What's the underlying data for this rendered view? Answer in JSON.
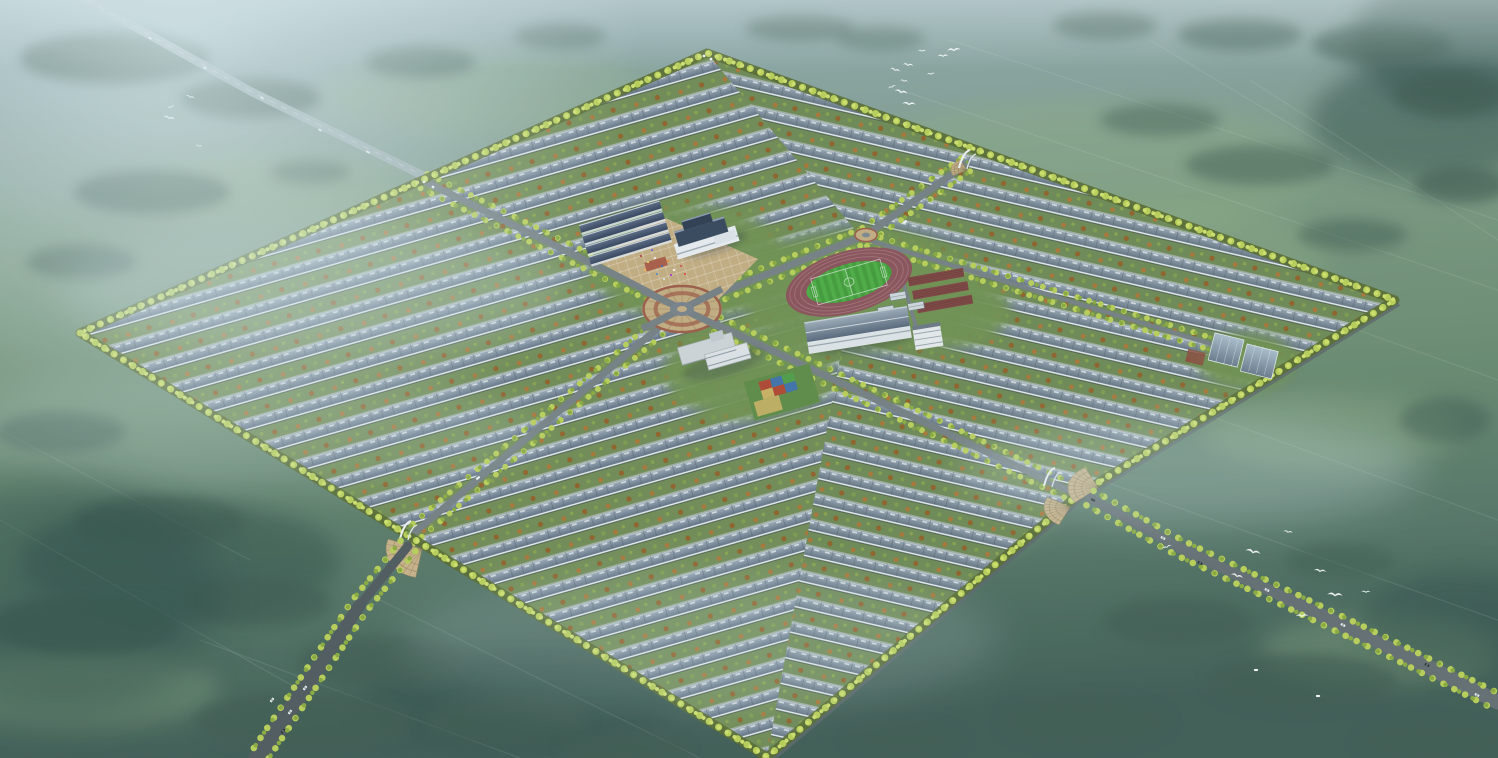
{
  "meta": {
    "scene_type": "aerial-architectural-rendering",
    "subject": "planned rural residential community master plan, bird's-eye view, misty farmland"
  },
  "palette": {
    "bgStops": [
      [
        0,
        "#93adb4"
      ],
      [
        0.18,
        "#86a09b"
      ],
      [
        0.35,
        "#78967f"
      ],
      [
        0.55,
        "#6b8b70"
      ],
      [
        0.78,
        "#547465"
      ],
      [
        1,
        "#3d5a52"
      ]
    ],
    "treeCluster": "#3e5a50",
    "lightField": "#8fae84",
    "darkField": "#2f4d47",
    "siteBase": "#7b8a7a",
    "roofDark": "#56667a",
    "roofLight": "#9fadb9",
    "roofDarkR": "#5a6a79",
    "roofLightR": "#9aa8b4",
    "courtyard": "#6f8a53",
    "courtyardR": "#6c8752",
    "eaveWhite": "#eaeff2",
    "treeYellow": "#b9cf55",
    "treeYellowLight": "#cfe06a",
    "treeOlive": "#88a83c",
    "treeBorderDark": "#55682e",
    "roadGray": "#747e82",
    "roadDark": "#4e585c",
    "roadMid": "#626c70",
    "highway": "#a3b2b7",
    "plazaTan": "#c3ac80",
    "ringBrown": "#9c5a45",
    "trackRed": "#8a5058",
    "pitchGreen": "#3f9b37",
    "pitchStripe": "#4bac41",
    "plotRed": "#7e4340",
    "glassTop": "#a9bcca",
    "glassBottom": "#68798a",
    "wallWhite": "#e7ebee",
    "navyRoof": "#33405c",
    "fogWhite": "#dfeef2",
    "birdWhite": "#f5f9f9",
    "carWhite": "#eef2f4",
    "carDark": "#23282c"
  },
  "background": {
    "lightPatches": [
      [
        500,
        95,
        180,
        40
      ],
      [
        1160,
        250,
        170,
        45
      ],
      [
        1080,
        170,
        240,
        70
      ],
      [
        1330,
        430,
        130,
        40
      ],
      [
        260,
        190,
        140,
        35
      ],
      [
        890,
        520,
        160,
        40
      ],
      [
        1380,
        650,
        120,
        35
      ],
      [
        80,
        690,
        140,
        40
      ]
    ],
    "darkPatches": [
      [
        1430,
        120,
        120,
        60
      ],
      [
        1470,
        40,
        120,
        70
      ],
      [
        1460,
        620,
        100,
        50
      ],
      [
        180,
        560,
        160,
        60
      ],
      [
        520,
        700,
        160,
        50
      ]
    ],
    "fieldLines": [
      [
        950,
        40,
        1498,
        220
      ],
      [
        900,
        90,
        1498,
        290
      ],
      [
        880,
        160,
        1498,
        380
      ],
      [
        1000,
        340,
        1498,
        520
      ],
      [
        1100,
        480,
        1498,
        620
      ],
      [
        150,
        380,
        680,
        650
      ],
      [
        0,
        430,
        250,
        560
      ],
      [
        0,
        520,
        300,
        690
      ],
      [
        1150,
        40,
        1350,
        160
      ],
      [
        1250,
        80,
        1498,
        240
      ],
      [
        380,
        600,
        700,
        758
      ],
      [
        200,
        640,
        520,
        758
      ]
    ],
    "treeClusters": [
      [
        115,
        58,
        95,
        26,
        0.75
      ],
      [
        250,
        98,
        70,
        20,
        0.7
      ],
      [
        420,
        62,
        55,
        16,
        0.5
      ],
      [
        560,
        36,
        46,
        13,
        0.45
      ],
      [
        152,
        192,
        78,
        22,
        0.65
      ],
      [
        82,
        262,
        55,
        17,
        0.6
      ],
      [
        310,
        172,
        40,
        12,
        0.5
      ],
      [
        800,
        28,
        55,
        13,
        0.5
      ],
      [
        880,
        38,
        45,
        12,
        0.45
      ],
      [
        1105,
        25,
        52,
        14,
        0.55
      ],
      [
        1240,
        34,
        62,
        16,
        0.6
      ],
      [
        1382,
        44,
        70,
        20,
        0.65
      ],
      [
        1448,
        95,
        55,
        22,
        0.7
      ],
      [
        1462,
        185,
        48,
        18,
        0.65
      ],
      [
        1260,
        165,
        75,
        20,
        0.5
      ],
      [
        1160,
        120,
        60,
        16,
        0.45
      ],
      [
        1352,
        235,
        55,
        16,
        0.5
      ],
      [
        1445,
        420,
        45,
        22,
        0.5
      ],
      [
        60,
        432,
        65,
        20,
        0.6
      ],
      [
        160,
        522,
        85,
        26,
        0.7
      ],
      [
        85,
        625,
        95,
        30,
        0.75
      ],
      [
        255,
        602,
        75,
        24,
        0.7
      ],
      [
        382,
        662,
        85,
        26,
        0.7
      ],
      [
        305,
        722,
        110,
        30,
        0.75
      ],
      [
        505,
        722,
        85,
        24,
        0.7
      ],
      [
        625,
        748,
        65,
        18,
        0.65
      ],
      [
        1178,
        622,
        75,
        24,
        0.65
      ],
      [
        1302,
        682,
        95,
        28,
        0.7
      ],
      [
        1432,
        742,
        75,
        22,
        0.7
      ],
      [
        1085,
        722,
        85,
        26,
        0.65
      ],
      [
        1340,
        562,
        55,
        18,
        0.5
      ],
      [
        905,
        740,
        60,
        16,
        0.6
      ]
    ]
  },
  "highway": {
    "pts": [
      [
        76,
        -6
      ],
      [
        252,
        92
      ],
      [
        432,
        180
      ]
    ],
    "width": 8.5,
    "cars": [
      [
        150,
        38
      ],
      [
        205,
        68
      ],
      [
        262,
        98
      ],
      [
        320,
        130
      ],
      [
        368,
        152
      ]
    ]
  },
  "site": {
    "polygon": [
      [
        80,
        333
      ],
      [
        707,
        53
      ],
      [
        1395,
        300
      ],
      [
        1078,
        495
      ],
      [
        767,
        757
      ]
    ],
    "leftZone": [
      [
        80,
        333
      ],
      [
        707,
        53
      ],
      [
        862,
        238
      ],
      [
        767,
        757
      ]
    ],
    "rightZone": [
      [
        707,
        53
      ],
      [
        1395,
        300
      ],
      [
        1078,
        495
      ],
      [
        767,
        757
      ],
      [
        862,
        238
      ]
    ],
    "wallEdge": [
      [
        1395,
        300
      ],
      [
        1078,
        495
      ],
      [
        767,
        757
      ]
    ],
    "rowAngleLeft": -16,
    "rowAngleRight": 13
  },
  "lawns": [
    [
      688,
      262,
      100,
      58
    ],
    [
      858,
      290,
      120,
      62
    ],
    [
      748,
      372,
      85,
      48
    ],
    [
      940,
      310,
      70,
      40
    ],
    [
      1246,
      362,
      48,
      30
    ]
  ],
  "internalRoads": [
    {
      "pts": [
        [
          424,
          181
        ],
        [
          682,
          308
        ],
        [
          1078,
          495
        ]
      ],
      "w": 7,
      "perp": [
        3.5,
        -7.2
      ],
      "trees": true
    },
    {
      "pts": [
        [
          408,
          538
        ],
        [
          682,
          308
        ],
        [
          866,
          235
        ],
        [
          968,
          163
        ]
      ],
      "w": 7,
      "perp": [
        4.5,
        6.6
      ],
      "trees": true
    },
    {
      "pts": [
        [
          868,
          240
        ],
        [
          1238,
          352
        ]
      ],
      "w": 4.5,
      "perp": [
        -1,
        6
      ],
      "trees": true
    },
    {
      "pts": [
        [
          893,
          247
        ],
        [
          917,
          330
        ]
      ],
      "w": 4,
      "perp": [
        0,
        0
      ],
      "trees": false
    }
  ],
  "features": {
    "plaza": {
      "polygon": [
        [
          598,
          262
        ],
        [
          654,
          213
        ],
        [
          758,
          259
        ],
        [
          702,
          316
        ]
      ],
      "carpet": {
        "x": 656,
        "y": 264,
        "w": 22,
        "h": 9,
        "rot": -17
      },
      "people": [
        [
          641,
          256
        ],
        [
          648,
          262
        ],
        [
          655,
          258
        ],
        [
          662,
          266
        ],
        [
          668,
          261
        ],
        [
          674,
          270
        ],
        [
          681,
          266
        ],
        [
          657,
          274
        ],
        [
          664,
          279
        ],
        [
          671,
          275
        ],
        [
          645,
          270
        ],
        [
          678,
          258
        ],
        [
          685,
          274
        ],
        [
          652,
          250
        ]
      ],
      "peopleColors": [
        "#b44444",
        "#ddd666",
        "#eeeeee",
        "#4466aa",
        "#ee8833",
        "#ffffff",
        "#cc5555",
        "#5588bb",
        "#dddddd",
        "#aa33cc",
        "#ffaa55",
        "#eeeeee",
        "#dd4444",
        "#6666cc"
      ]
    },
    "schoolRows": {
      "cx": 625,
      "cy": 232,
      "rot": -17,
      "count": 4,
      "len": 84
    },
    "townHall": {
      "cx": 708,
      "cy": 240,
      "rot": -17
    },
    "circlePlaza": {
      "cx": 682,
      "cy": 309,
      "rx": 40,
      "ry": 24,
      "spokes": 16
    },
    "miniRoundabout": {
      "cx": 866,
      "cy": 235,
      "rx": 11,
      "ry": 6.5
    },
    "sportsField": {
      "cx": 849,
      "cy": 282,
      "rot": -16,
      "trackRx": 65,
      "trackRy": 31,
      "pitchRx": 44,
      "pitchRy": 18
    },
    "gardenPlots": {
      "cx": 940,
      "cy": 288,
      "rot": -10
    },
    "farmHouses": [
      [
        898,
        296,
        -10
      ],
      [
        916,
        306,
        -10
      ],
      [
        886,
        310,
        -10
      ]
    ],
    "longBuilding": {
      "cx": 858,
      "cy": 330,
      "rot": -9
    },
    "whiteBuilding": {
      "cx": 928,
      "cy": 338,
      "rot": -9
    },
    "greenhouse": {
      "cx": 1246,
      "cy": 357,
      "rot": 14
    },
    "kindergarten": {
      "cx": 722,
      "cy": 358,
      "rot": -16
    },
    "playground": {
      "cx": 782,
      "cy": 392,
      "rot": -16,
      "colors": [
        "#b0452f",
        "#3d6fa8",
        "#4e9c44",
        "#c9b061",
        "#b0452f",
        "#3d6fa8"
      ]
    },
    "entrances": {
      "bottomLeftFan": {
        "cx": 422,
        "cy": 549,
        "r": 36,
        "a0": 100,
        "a1": 200,
        "sq": 0.8
      },
      "rightFanA": {
        "cx": 1098,
        "cy": 488,
        "r": 30,
        "a0": 140,
        "a1": 245,
        "sq": 0.75
      },
      "rightFanB": {
        "cx": 1070,
        "cy": 507,
        "r": 26,
        "a0": 115,
        "a1": 210,
        "sq": 0.75
      },
      "topRightFan": {
        "cx": 967,
        "cy": 170,
        "r": 16,
        "a0": 150,
        "a1": 245,
        "sq": 0.7
      },
      "gateDots": [
        [
          704,
          56
        ],
        [
          711,
          59
        ],
        [
          424,
          182
        ],
        [
          433,
          187
        ]
      ],
      "gateSculptures": [
        [
          406,
          531
        ],
        [
          1050,
          478
        ],
        [
          965,
          160
        ]
      ]
    }
  },
  "externalRoads": [
    {
      "pts": [
        [
          408,
          546
        ],
        [
          360,
          605
        ],
        [
          318,
          668
        ],
        [
          282,
          722
        ],
        [
          258,
          758
        ]
      ],
      "w0": 9,
      "w1": 19,
      "color": "roadDark",
      "treeOff": [
        7.4,
        5.2
      ],
      "cars": [
        [
          272,
          700,
          -52,
          "carWhite"
        ],
        [
          290,
          712,
          -52,
          "carWhite"
        ],
        [
          305,
          688,
          -52,
          "carWhite"
        ],
        [
          283,
          731,
          -52,
          "carDark"
        ]
      ]
    },
    {
      "pts": [
        [
          1090,
          498
        ],
        [
          1180,
          548
        ],
        [
          1290,
          600
        ],
        [
          1400,
          653
        ],
        [
          1498,
          702
        ]
      ],
      "w0": 9,
      "w1": 15,
      "color": "roadMid",
      "treeOff": [
        -3.6,
        7.2
      ],
      "cars": [
        [
          1163,
          538,
          27,
          "carWhite"
        ],
        [
          1200,
          563,
          27,
          "carDark"
        ],
        [
          1267,
          590,
          27,
          "carWhite"
        ],
        [
          1343,
          625,
          27,
          "carWhite"
        ],
        [
          1427,
          665,
          27,
          "carDark"
        ],
        [
          1477,
          695,
          27,
          "carWhite"
        ]
      ]
    }
  ],
  "internalCars": [
    [
      478,
      478,
      -40,
      "carWhite"
    ],
    [
      1093,
      500,
      28,
      "carDark"
    ],
    [
      905,
      222,
      -35,
      "carWhite"
    ]
  ],
  "birds": {
    "flockTop": [
      [
        892,
        87
      ],
      [
        895,
        70
      ],
      [
        901,
        92
      ],
      [
        904,
        81
      ],
      [
        908,
        65
      ],
      [
        909,
        104
      ],
      [
        922,
        51
      ],
      [
        943,
        56
      ],
      [
        954,
        50
      ],
      [
        931,
        74
      ]
    ],
    "flockLeft": [
      [
        171,
        107
      ],
      [
        190,
        97
      ],
      [
        169,
        118
      ],
      [
        199,
        146
      ]
    ],
    "flockRight": [
      [
        1167,
        547
      ],
      [
        1237,
        576
      ],
      [
        1253,
        552
      ],
      [
        1288,
        532
      ],
      [
        1320,
        571
      ],
      [
        1335,
        595
      ],
      [
        1366,
        592
      ],
      [
        1302,
        616
      ]
    ],
    "groundBirds": [
      [
        1256,
        670
      ],
      [
        1318,
        696
      ]
    ]
  },
  "fog": {
    "mistBands": [
      [
        320,
        290,
        260,
        70,
        0.25
      ],
      [
        1190,
        470,
        230,
        55,
        0.28
      ],
      [
        700,
        640,
        300,
        70,
        0.15
      ],
      [
        240,
        430,
        300,
        60,
        0.18
      ]
    ],
    "darkCorner": [
      60,
      600,
      160,
      120,
      0.4
    ]
  }
}
